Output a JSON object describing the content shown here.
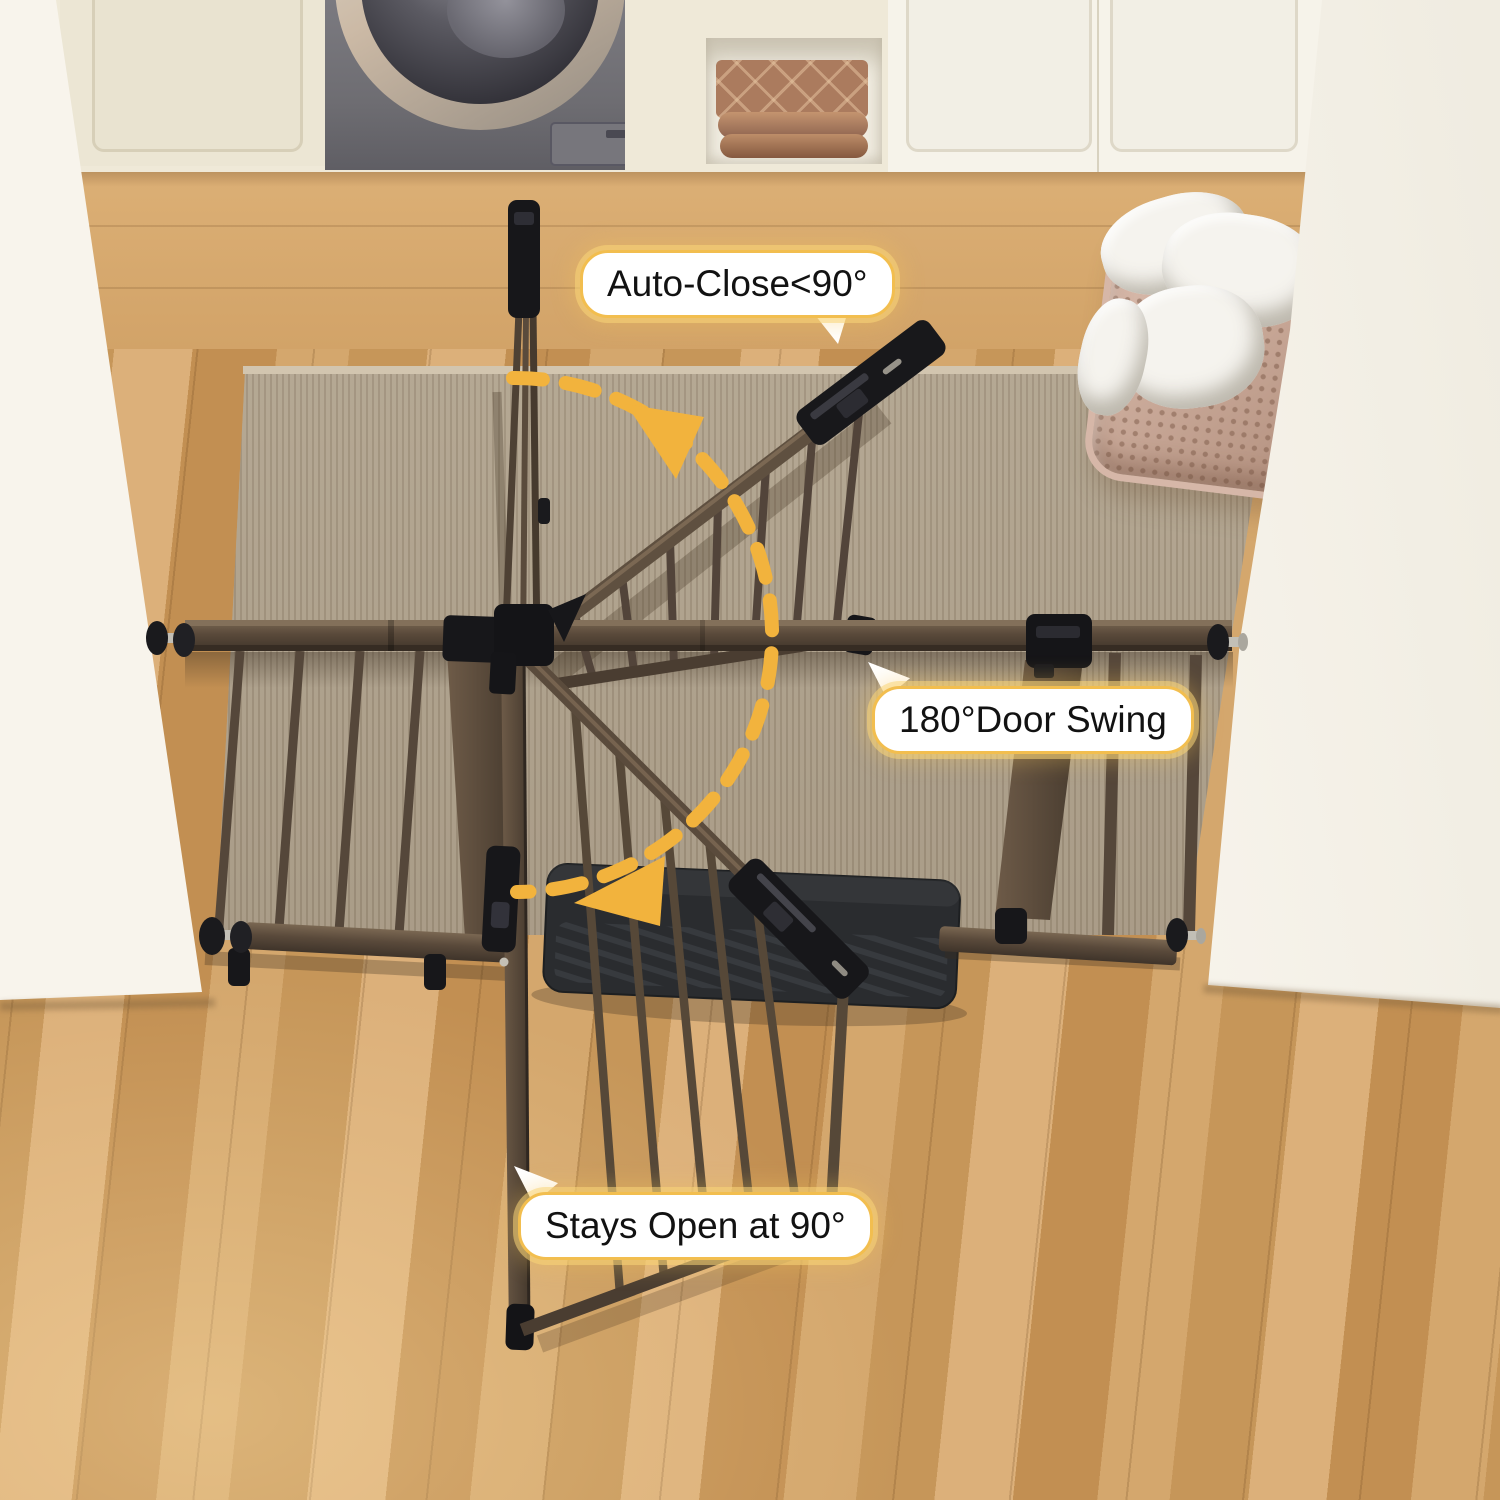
{
  "annotations": {
    "auto_close": {
      "label": "Auto-Close<90°"
    },
    "door_swing": {
      "label": "180°Door Swing"
    },
    "stays_open": {
      "label": "Stays Open at 90°"
    }
  },
  "colors": {
    "accent_yellow": "#F2B33D",
    "callout_border": "#F2BE4F",
    "callout_bg": "#FFFFFF",
    "callout_text": "#121212",
    "gate_brown": "#54453A",
    "gate_brown_light": "#75624E",
    "gate_brown_dark": "#3A2F26",
    "hardware_black": "#17171A",
    "threshold_mat_gray": "#2A2C2F",
    "rug_taupe": "#B3A48E",
    "floor_wood": "#CF9F63",
    "wall_cream": "#F7F3EA",
    "cabinet_cream": "#EFE9D8",
    "washer_gray": "#6E6D72",
    "washer_ring_champagne": "#CBB9A5",
    "towel_terracotta": "#AB7B5E",
    "basket_blush": "#C8A696",
    "laundry_white": "#F5F3EE"
  }
}
